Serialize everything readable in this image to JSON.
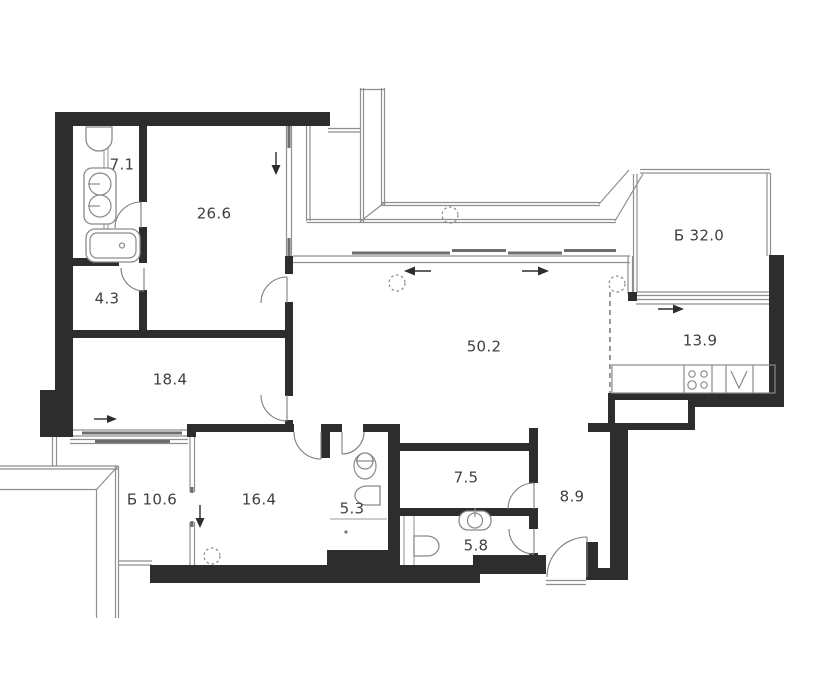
{
  "plan": {
    "type": "apartment-floor-plan",
    "rooms": [
      {
        "id": "bathroom-top",
        "label": "7.1",
        "x": 122,
        "y": 165
      },
      {
        "id": "bedroom-top",
        "label": "26.6",
        "x": 214,
        "y": 214
      },
      {
        "id": "closet-hall",
        "label": "4.3",
        "x": 107,
        "y": 299
      },
      {
        "id": "bedroom-left",
        "label": "18.4",
        "x": 170,
        "y": 380
      },
      {
        "id": "balcony-left",
        "label": "Б 10.6",
        "x": 152,
        "y": 500
      },
      {
        "id": "bedroom-bottom",
        "label": "16.4",
        "x": 259,
        "y": 500
      },
      {
        "id": "wc-small",
        "label": "5.3",
        "x": 352,
        "y": 509
      },
      {
        "id": "living-room",
        "label": "50.2",
        "x": 484,
        "y": 347
      },
      {
        "id": "storage",
        "label": "7.5",
        "x": 466,
        "y": 478
      },
      {
        "id": "wc-guest",
        "label": "5.8",
        "x": 476,
        "y": 546
      },
      {
        "id": "entry-hall",
        "label": "8.9",
        "x": 572,
        "y": 497
      },
      {
        "id": "terrace-right",
        "label": "Б 32.0",
        "x": 699,
        "y": 236
      },
      {
        "id": "kitchen",
        "label": "13.9",
        "x": 700,
        "y": 341
      }
    ],
    "fixtures": [
      "toilet-icon",
      "double-washbasin-icon",
      "bathtub-icon",
      "washbasin-icon",
      "stove-icon",
      "kitchen-sink-icon",
      "downlight-marker",
      "door-swing-arc",
      "opening-direction-arrow"
    ],
    "colors": {
      "wall": "#2d2d2d",
      "thin_line": "#8f8f8f",
      "sash": "#6e6e6e",
      "label": "#3f3f3f",
      "background": "#ffffff"
    }
  }
}
